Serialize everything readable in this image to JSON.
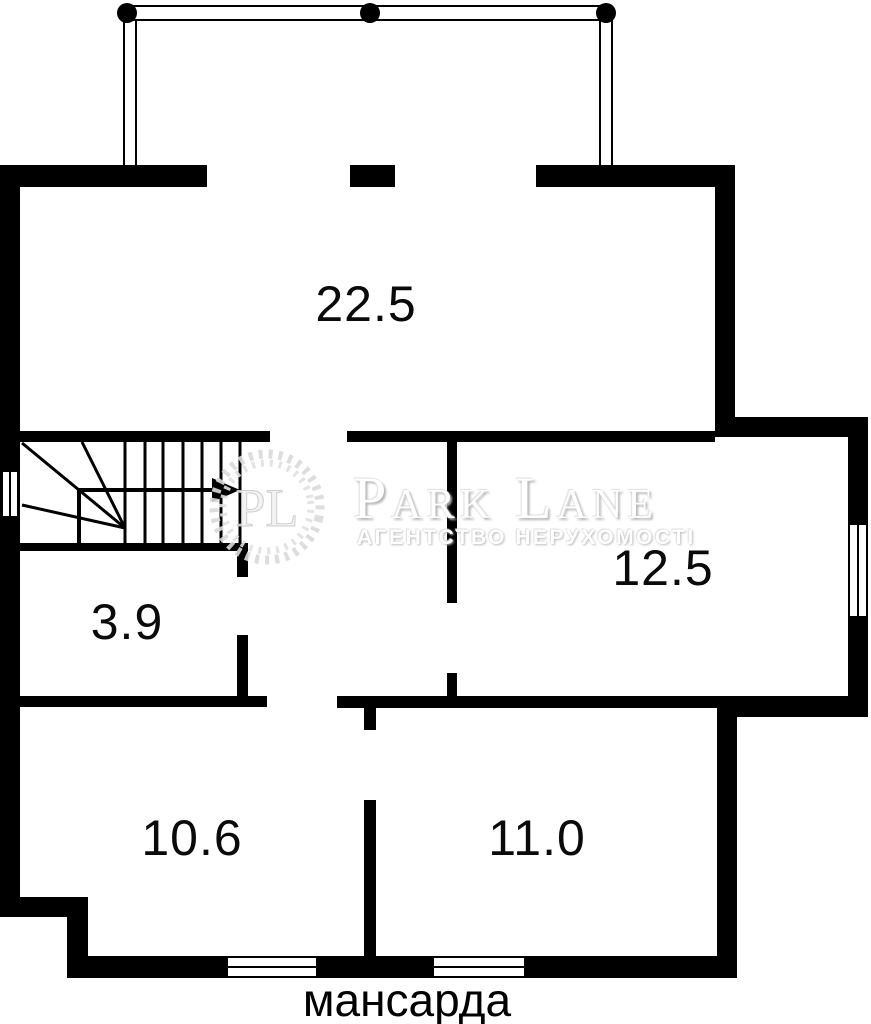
{
  "floor": {
    "label": "мансарда"
  },
  "rooms": [
    {
      "name": "room-top",
      "area": "22.5"
    },
    {
      "name": "room-right",
      "area": "12.5"
    },
    {
      "name": "hall",
      "area": "3.9"
    },
    {
      "name": "room-bottom-left",
      "area": "10.6"
    },
    {
      "name": "room-bottom-right",
      "area": "11.0"
    }
  ],
  "watermark": {
    "monogram": "PL",
    "brand": "Park Lane",
    "tagline": "агентство нерухомості"
  },
  "colors": {
    "walls": "#000000",
    "background": "#ffffff",
    "labels": "#0a0a0a",
    "watermark": "#e3e3e3"
  }
}
